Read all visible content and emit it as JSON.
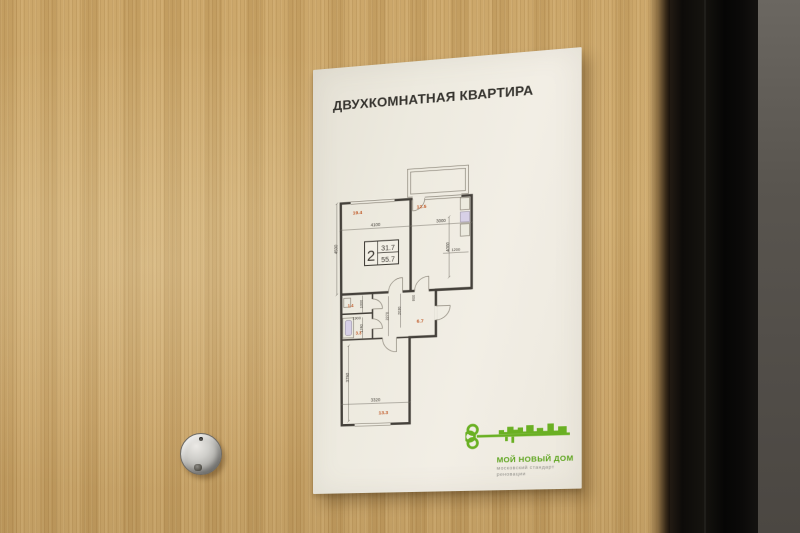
{
  "poster": {
    "title": "ДВУХКОМНАТНАЯ КВАРТИРА",
    "plan": {
      "label": {
        "rooms_count": "2",
        "living_area": "31.7",
        "total_area": "55.7"
      },
      "areas": {
        "living_room": "19.4",
        "bedroom": "12.5",
        "hallway": "6.7",
        "wc": "1.4",
        "bathroom": "3.3",
        "kitchen": "13.3"
      },
      "dims": {
        "living_width": "4100",
        "bedroom_width": "3000",
        "living_depth": "4500",
        "bedroom_depth": "4000",
        "niche_width": "1200",
        "wc_depth": "1000",
        "bath_width": "1900",
        "bath_depth": "1740",
        "hall_depth_a": "2270",
        "hall_depth_b": "2030",
        "jog_width": "600",
        "kitchen_depth": "3790",
        "kitchen_width": "3320"
      }
    },
    "logo": {
      "brand": "МОЙ НОВЫЙ ДОМ",
      "tagline_line1": "московский стандарт",
      "tagline_line2": "реновации"
    }
  },
  "colors": {
    "logo_green": "#6ab023",
    "plan_area_red": "#c05a28",
    "door_wood": "#c8a263",
    "door_edge_black": "#0d0b09",
    "wall_gray": "#56524c",
    "poster_paper": "#efece2"
  }
}
